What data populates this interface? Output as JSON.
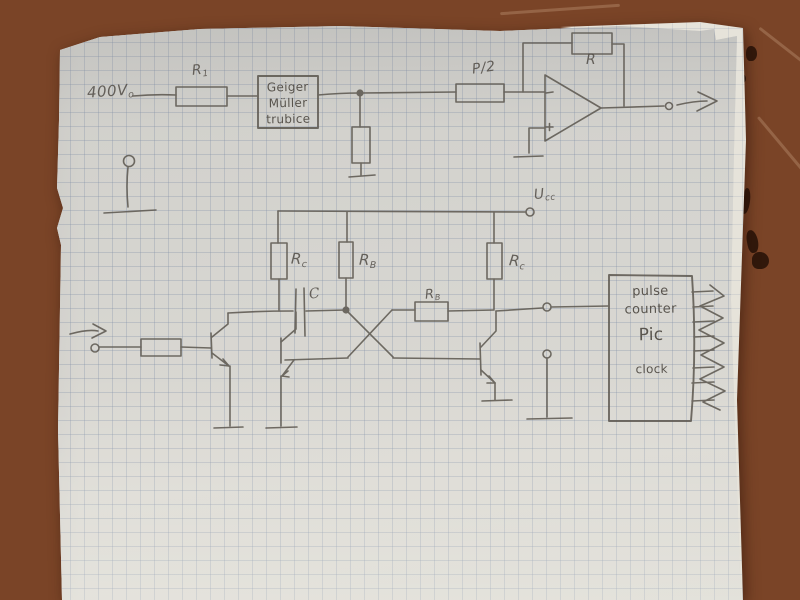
{
  "photo": {
    "description": "hand-drawn Geiger counter circuit schematic on squared graph paper lying on a reddish-brown table",
    "table_color": "#8d5134",
    "paper_color": "#d6d5d0",
    "grid_color": "#7d8ca5",
    "pencil_color": "#5b564e"
  },
  "schematic": {
    "hv_label": {
      "main": "400V",
      "sub": "o"
    },
    "r1_label": {
      "main": "R",
      "sub": "1"
    },
    "geiger_box": {
      "line1": "Geiger",
      "line2": "Müller",
      "line3": "trubice"
    },
    "pot_label": "P/2",
    "feedback_r_label": "R",
    "opamp_plus": "+",
    "ucc_label": {
      "main": "U",
      "sub": "cc"
    },
    "rc_left_label": {
      "main": "R",
      "sub": "c"
    },
    "rb_mid_label": {
      "main": "R",
      "sub": "B"
    },
    "rc_right_label": {
      "main": "R",
      "sub": "c"
    },
    "cap_label": "C",
    "rb_cross_label": {
      "main": "R",
      "sub": "B"
    },
    "counter_box": {
      "line1": "pulse",
      "line2": "counter",
      "line3": "Pic",
      "line4": "clock"
    }
  }
}
